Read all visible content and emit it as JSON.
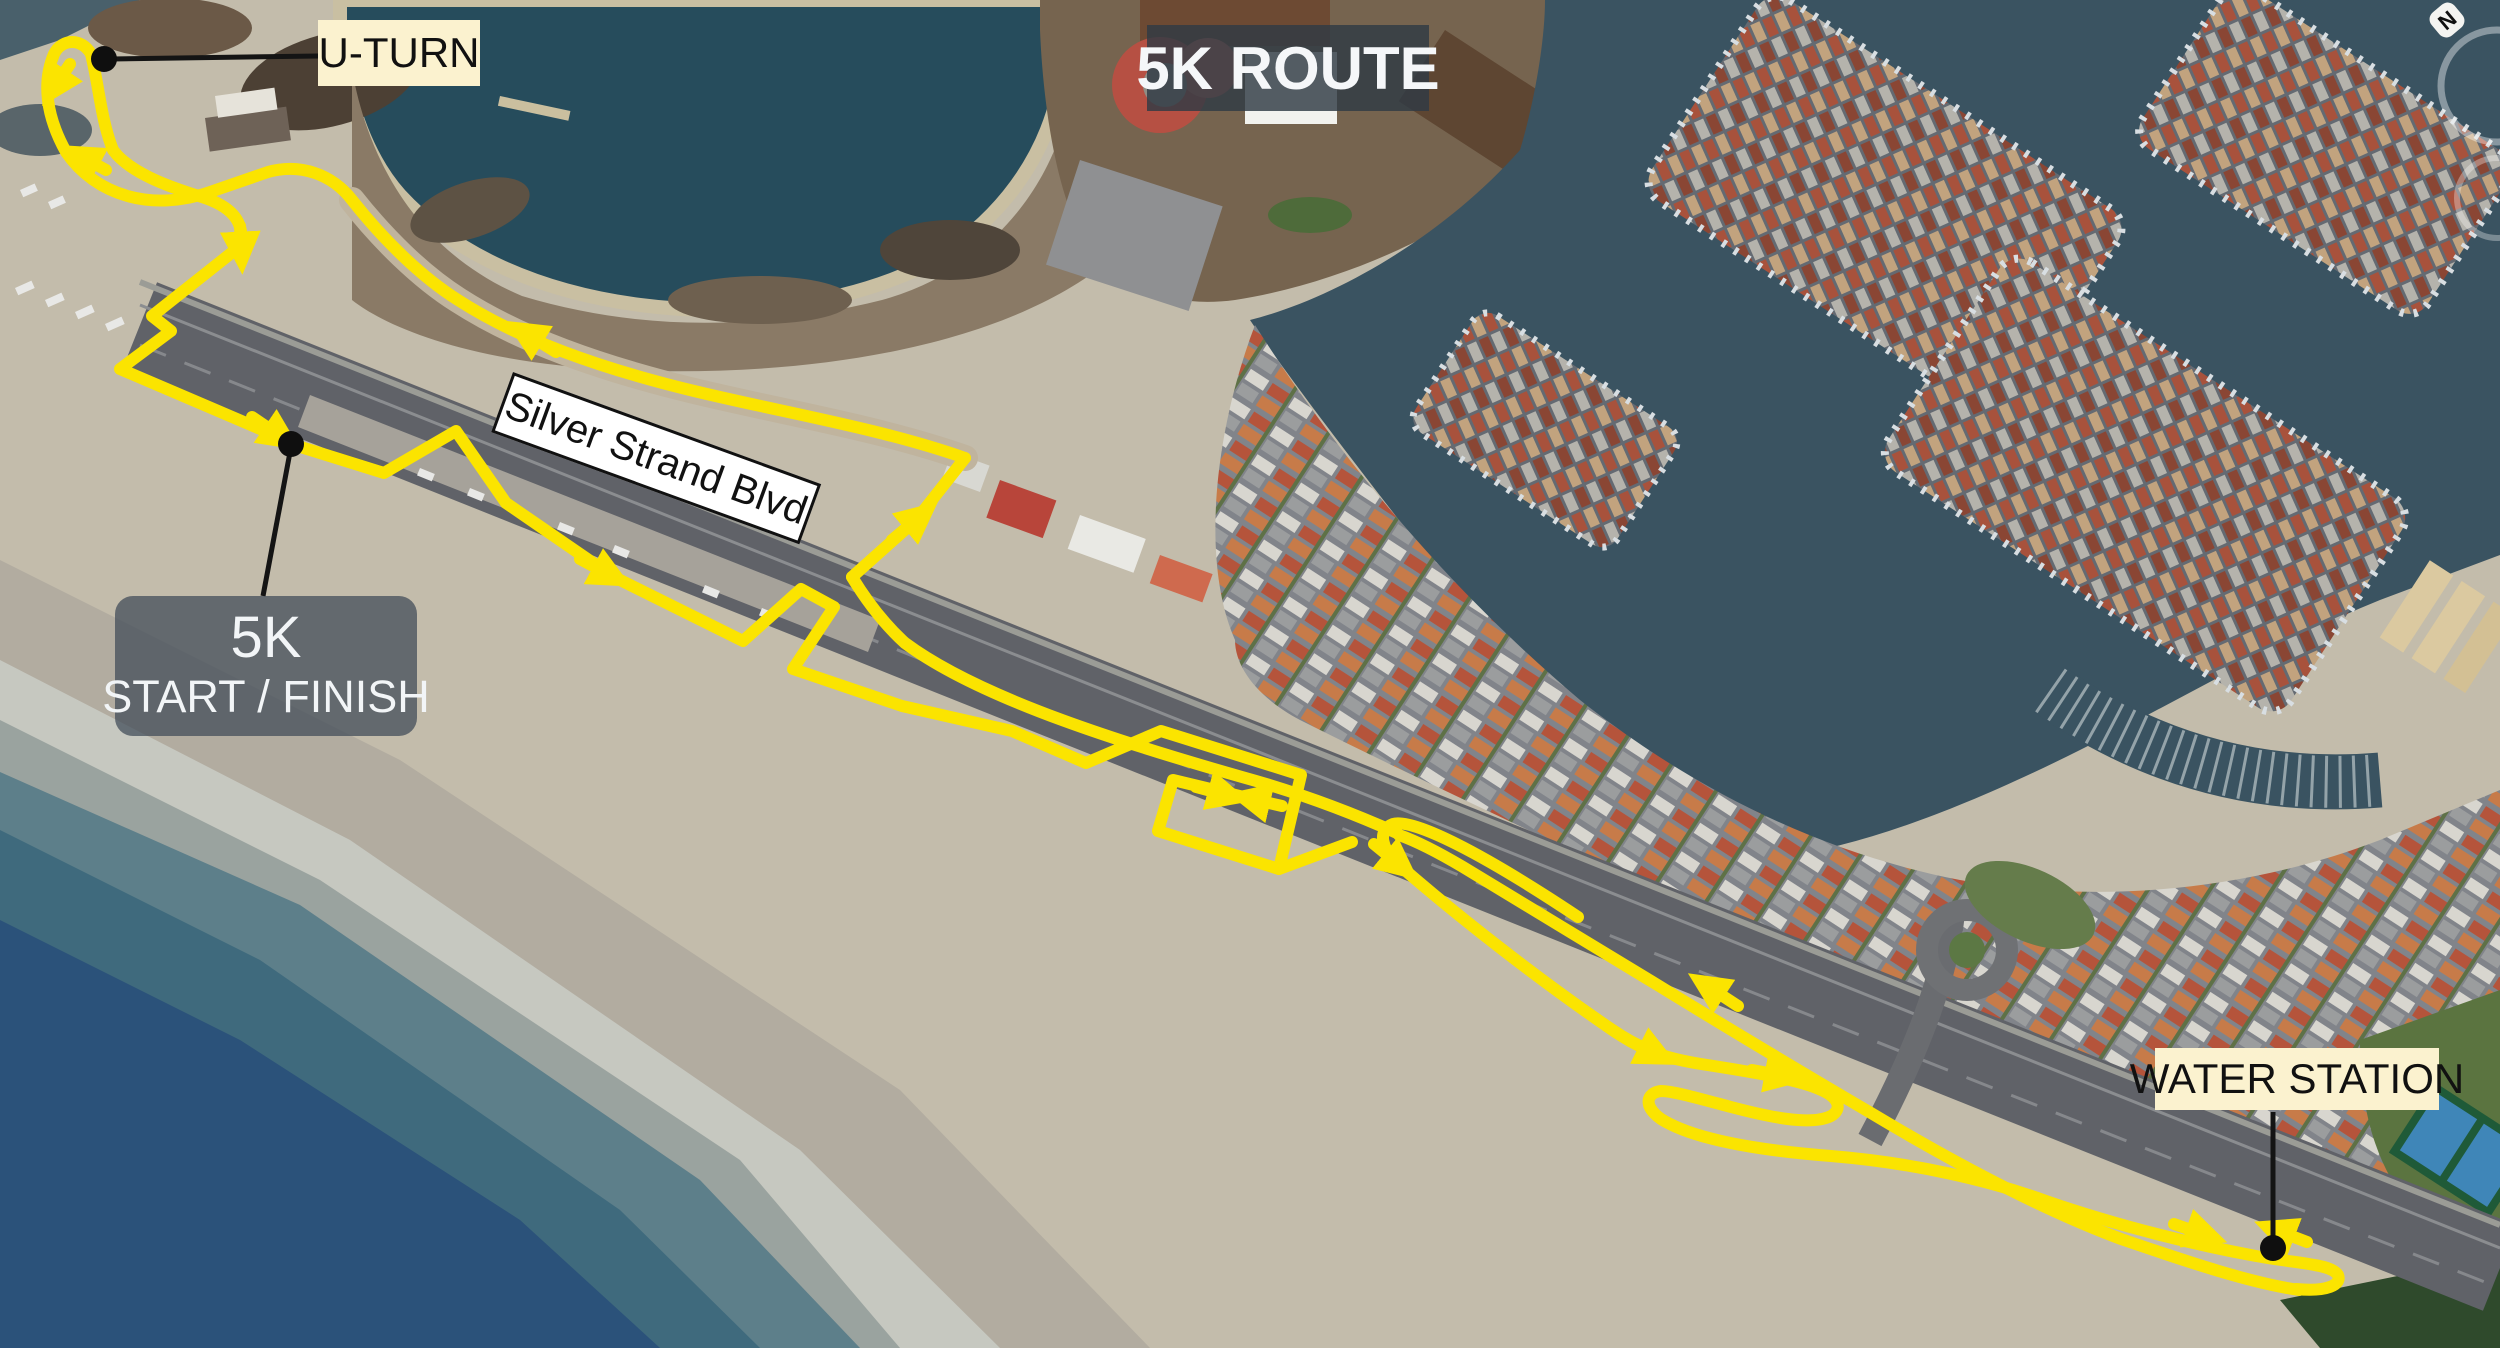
{
  "map": {
    "type": "satellite-route-map",
    "title": "5K ROUTE",
    "street_label": "Silver Strand Blvd",
    "annotations": {
      "uturn": "U-TURN",
      "start_finish_line1": "5K",
      "start_finish_line2": "START / FINISH",
      "water_station": "WATER STATION"
    },
    "compass": {
      "north": "N"
    },
    "colors": {
      "route": "#fbe400",
      "leader_line": "#141414",
      "cream_label_bg": "#fbf2cf",
      "dark_label_bg": "rgba(47,58,68,0.82)",
      "street_label_bg": "#ffffff",
      "ocean_deep": "#2b527a",
      "bay_water": "#264c5c",
      "marina_water": "#3a5361",
      "sand": "#c3bcab",
      "road": "#606268"
    }
  }
}
